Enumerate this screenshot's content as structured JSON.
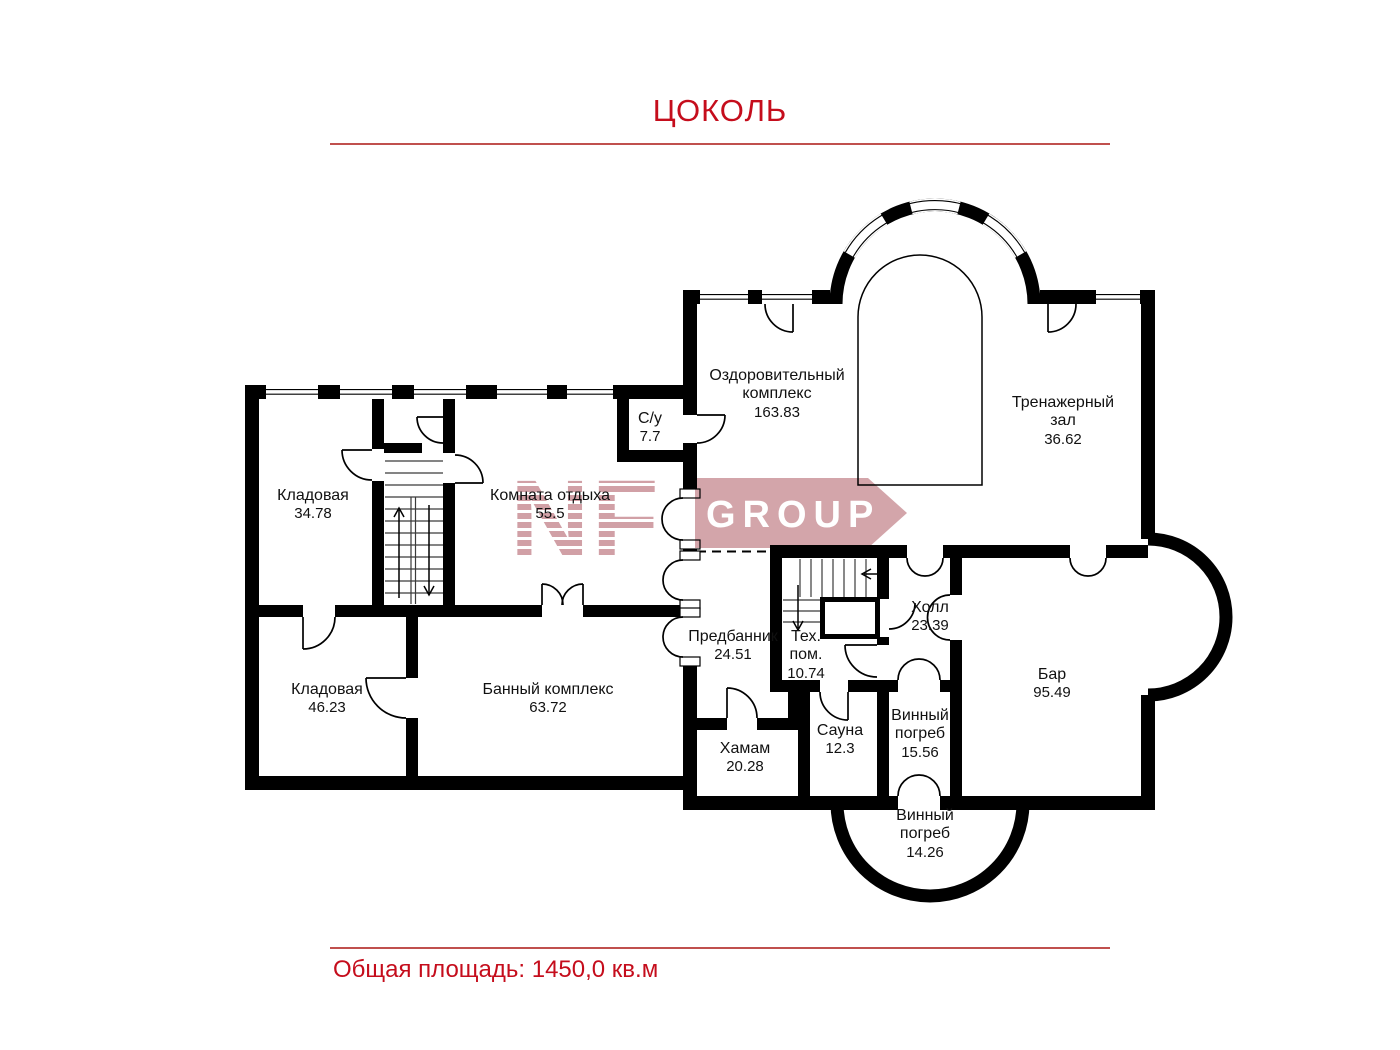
{
  "title": "ЦОКОЛЬ",
  "floor_plan": {
    "rooms": [
      {
        "name": "Кладовая",
        "area": "34.78"
      },
      {
        "name": "Комната отдыха",
        "area": "55.5"
      },
      {
        "name": "С/у",
        "area": "7.7"
      },
      {
        "name": "Оздоровительный\nкомплекс",
        "area": "163.83"
      },
      {
        "name": "Тренажерный\nзал",
        "area": "36.62"
      },
      {
        "name": "Кладовая",
        "area": "46.23"
      },
      {
        "name": "Банный комплекс",
        "area": "63.72"
      },
      {
        "name": "Предбанник",
        "area": "24.51"
      },
      {
        "name": "Тех.\nпом.",
        "area": "10.74"
      },
      {
        "name": "Холл",
        "area": "23.39"
      },
      {
        "name": "Бар",
        "area": "95.49"
      },
      {
        "name": "Хамам",
        "area": "20.28"
      },
      {
        "name": "Сауна",
        "area": "12.3"
      },
      {
        "name": "Винный\nпогреб",
        "area": "15.56"
      },
      {
        "name": "Винный\nпогреб",
        "area": "14.26"
      }
    ]
  },
  "watermark": {
    "letters": "NF",
    "group_label": "GROUP"
  },
  "footer": {
    "total_area": "Общая площадь: 1450,0 кв.м"
  },
  "colors": {
    "accent_red": "#c50d1c",
    "rule_red": "#c0504d",
    "wall_black": "#000000",
    "watermark_pink": "#cc959b",
    "room_text": "#111111"
  }
}
